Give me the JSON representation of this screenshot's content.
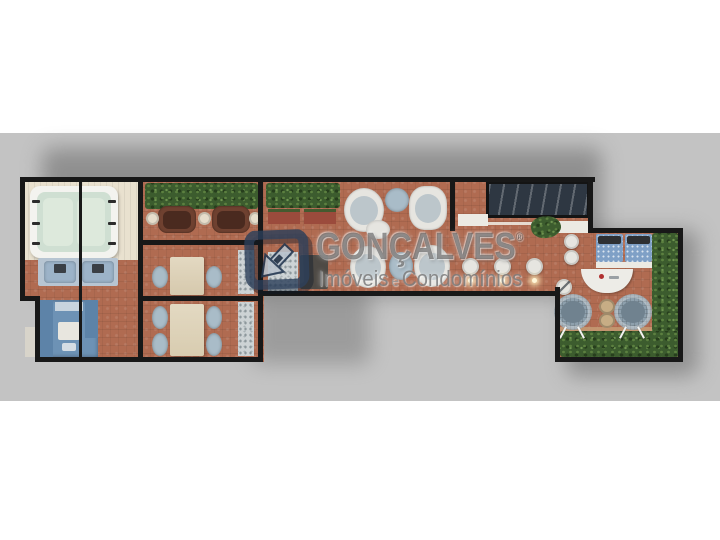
{
  "watermark": {
    "brand": "GONÇALVES",
    "registered": "®",
    "tagline": {
      "left": "Imóveis",
      "conjunction": "e",
      "right": "Condomínios"
    }
  },
  "palette": {
    "page_bg": "#ffffff",
    "band_bg": "#c3c3c3",
    "shadow": "#6e6e6e",
    "wall": "#181818",
    "floor_terracotta": "#b06b51",
    "floor_deck": "#e9e1cf",
    "hedge": "#3c5c2e",
    "hedge_light": "#5c8040",
    "stone": "#cdd3d5",
    "tub_rim": "#f3f3ef",
    "tub_water": "#cfdfd2",
    "tub_seat": "#dde9dc",
    "mat_blue": "#b7c5d2",
    "lounger_blue": "#9cb3c8",
    "cabinet_blue": "#6d92b5",
    "cabinet_dark": "#5d83a8",
    "wicker_brown": "#6f4130",
    "cushion_brown": "#4a2a1f",
    "side_table_cream": "#e6ddcb",
    "table_wood": "#ddd2b8",
    "chair_gray": "#a9bcc8",
    "chair_white": "#e6e5e0",
    "chair_inner": "#bcc6cb",
    "planter_brick": "#9b4b3c",
    "counter_dark": "#4e4a45",
    "skylight": "#2e3742",
    "ledge_white": "#eceae3",
    "daybed_blue": "#7fa0c6",
    "pillow_dark": "#2e3033",
    "egg_chair": "#8ea0ad",
    "egg_inner": "#70828f",
    "fig8_tan": "#c7ad85",
    "glow": "#fff6d8",
    "wm_frame": "#2b3f5a",
    "wm_arrow": "#b9c3cd",
    "wm_brand": "rgba(72,72,72,0.58)",
    "wm_tagline": "rgba(122,122,122,0.85)"
  }
}
